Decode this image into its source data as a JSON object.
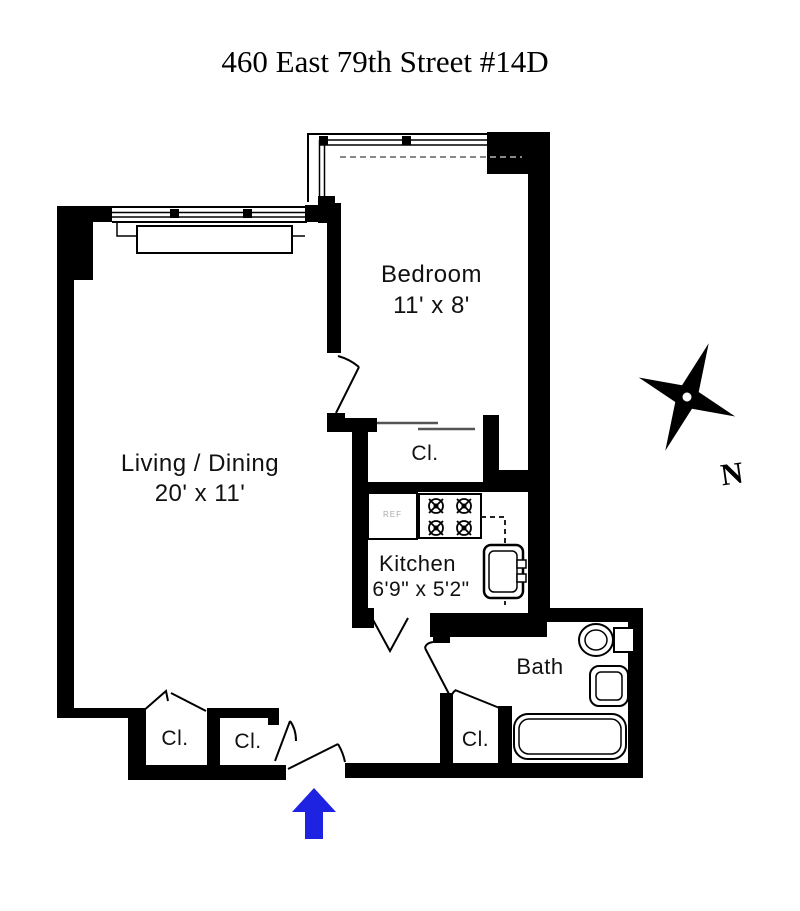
{
  "title": "460 East 79th Street #14D",
  "compass": {
    "north_label": "N"
  },
  "entrance": {
    "arrow_color": "#1d23e0"
  },
  "colors": {
    "wall": "#000000",
    "background": "#ffffff",
    "dashed_line": "#888888"
  },
  "rooms": {
    "living_dining": {
      "name": "Living / Dining",
      "dimensions": "20' x 11'"
    },
    "bedroom": {
      "name": "Bedroom",
      "dimensions": "11' x 8'"
    },
    "kitchen": {
      "name": "Kitchen",
      "dimensions": "6'9\" x 5'2\""
    },
    "bath": {
      "name": "Bath"
    }
  },
  "closets": {
    "bedroom_closet": "Cl.",
    "hall_closet_left": "Cl.",
    "hall_closet_right": "Cl.",
    "bath_closet": "Cl."
  },
  "appliances": {
    "refrigerator": "REF"
  }
}
